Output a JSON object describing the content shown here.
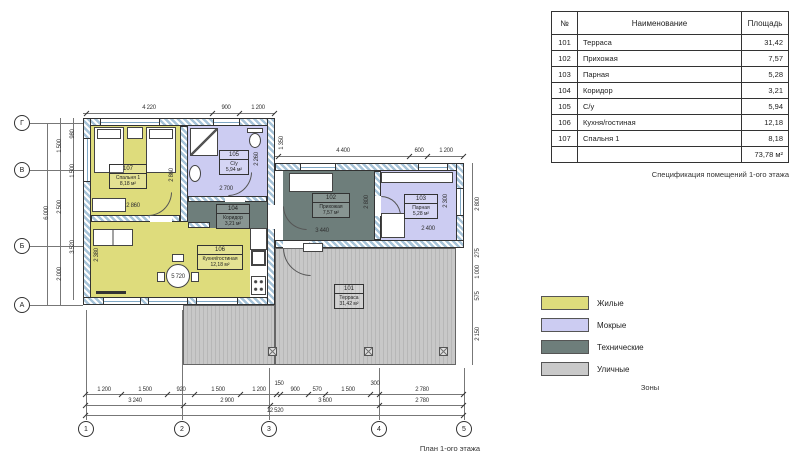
{
  "table": {
    "headers": [
      "№",
      "Наименование",
      "Площадь"
    ],
    "rows": [
      {
        "num": "101",
        "name": "Терраса",
        "area": "31,42"
      },
      {
        "num": "102",
        "name": "Прихожая",
        "area": "7,57"
      },
      {
        "num": "103",
        "name": "Парная",
        "area": "5,28"
      },
      {
        "num": "104",
        "name": "Коридор",
        "area": "3,21"
      },
      {
        "num": "105",
        "name": "С/у",
        "area": "5,94"
      },
      {
        "num": "106",
        "name": "Кухня/гостиная",
        "area": "12,18"
      },
      {
        "num": "107",
        "name": "Спальня 1",
        "area": "8,18"
      }
    ],
    "total": "73,78 м²",
    "caption": "Спецификация помещений 1-ого этажа"
  },
  "legend": {
    "items": [
      {
        "label": "Жилые",
        "color": "#dedc7c"
      },
      {
        "label": "Мокрые",
        "color": "#ccccf2"
      },
      {
        "label": "Технические",
        "color": "#6e7e7b"
      },
      {
        "label": "Уличные",
        "color": "#c9c9c9"
      }
    ],
    "caption": "Зоны"
  },
  "plan": {
    "caption": "План 1-ого этажа",
    "rooms": [
      {
        "num": "107",
        "name": "Спальня 1",
        "area": "8,18 м²"
      },
      {
        "num": "105",
        "name": "С/у",
        "area": "5,94 м²"
      },
      {
        "num": "104",
        "name": "Коридор",
        "area": "3,21 м²"
      },
      {
        "num": "102",
        "name": "Прихожая",
        "area": "7,57 м²"
      },
      {
        "num": "103",
        "name": "Парная",
        "area": "5,28 м²"
      },
      {
        "num": "106",
        "name": "Кухня/гостиная",
        "area": "12,18 м²"
      },
      {
        "num": "101",
        "name": "Терраса",
        "area": "31,42 м²"
      }
    ],
    "axes": {
      "cols": [
        "1",
        "2",
        "3",
        "4",
        "5"
      ],
      "rows": [
        "Г",
        "В",
        "Б",
        "А"
      ]
    },
    "dims": {
      "top": [
        "4 220",
        "900",
        "1 200"
      ],
      "wing_top": [
        "4 400",
        "600",
        "1 200"
      ],
      "bottom_row1": [
        "1 200",
        "1 500",
        "920",
        "1 500",
        "1 200",
        "150",
        "900",
        "570",
        "1 500",
        "300",
        "2 780"
      ],
      "bottom_row2": [
        "3 240",
        "2 900",
        "3 600",
        "2 780"
      ],
      "bottom_total": "12 520",
      "left_inner": [
        "980",
        "1 500",
        "3 520"
      ],
      "left_mid": [
        "1 500",
        "2 500",
        "2 000"
      ],
      "left_total": "6 000",
      "right": [
        "1 350",
        "2 800",
        "275",
        "1 000",
        "575",
        "2 150"
      ],
      "room_inner": [
        "2 860",
        "2 860",
        "2 700",
        "2 260",
        "3 440",
        "2 800",
        "2 400",
        "2 300",
        "5 720",
        "2 380"
      ]
    }
  }
}
